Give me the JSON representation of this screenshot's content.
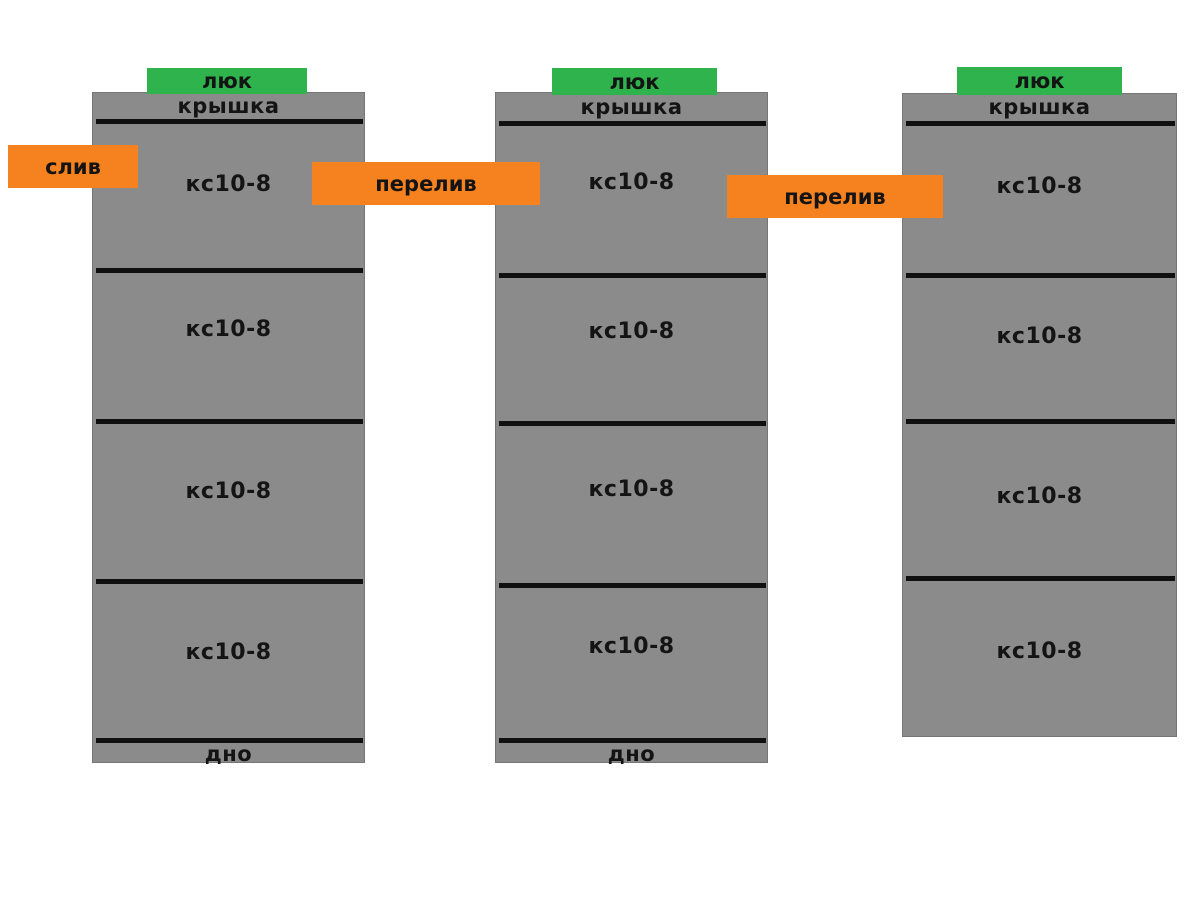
{
  "colors": {
    "tank_gray": "#8b8b8b",
    "hatch_green": "#2eb34d",
    "label_orange": "#f6821f",
    "line_black": "#101010"
  },
  "tanks": [
    {
      "hatch": "люк",
      "cover": "крышка",
      "rings": [
        "кс10-8",
        "кс10-8",
        "кс10-8",
        "кс10-8"
      ],
      "bottom": "дно"
    },
    {
      "hatch": "люк",
      "cover": "крышка",
      "rings": [
        "кс10-8",
        "кс10-8",
        "кс10-8",
        "кс10-8"
      ],
      "bottom": "дно"
    },
    {
      "hatch": "люк",
      "cover": "крышка",
      "rings": [
        "кс10-8",
        "кс10-8",
        "кс10-8",
        "кс10-8"
      ]
    }
  ],
  "labels": {
    "drain": "слив",
    "overflow_left": "перелив",
    "overflow_right": "перелив"
  }
}
